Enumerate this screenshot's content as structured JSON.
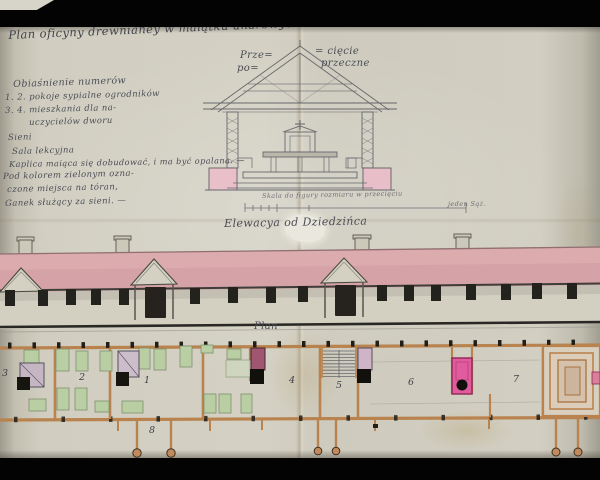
{
  "photo": {
    "description": "Photograph of a 19th-century hand-drawn architectural sheet (section, elevation, floor plan) on aged folded paper, letterboxed by black bars"
  },
  "title": "Plan oficyny drewnianey w maiątku unarowyckim Zameczku",
  "legend": {
    "heading": "Obiaśnienie numerów",
    "lines": [
      "1. 2. pokoje sypialne ogrodników",
      "3. 4. mieszkania dla na-",
      "uczycielów dworu",
      "Sieni",
      "Sala lekcyjna",
      "Kaplica maiąca się dobudować, i ma być opalana. —",
      "Pod kolorem zielonym ozna-",
      "czone miejsca na tóran,",
      "Ganek służący za sieni. —"
    ]
  },
  "cross_section": {
    "label_left_top": "Prze=",
    "label_left_bottom": "po=",
    "label_right_top": "= cięcie",
    "label_right_bottom": "przeczne"
  },
  "scale": {
    "caption": "Skala do figury rozmiaru w przecięciu",
    "unit_label": "jeden Sąż."
  },
  "elevation": {
    "caption": "Elewacya od Dziedzińca"
  },
  "plan": {
    "caption": "Plan",
    "rooms": [
      {
        "label": "3"
      },
      {
        "label": "2"
      },
      {
        "label": "1"
      },
      {
        "label": "4"
      },
      {
        "label": "5"
      },
      {
        "label": "6"
      },
      {
        "label": "7"
      },
      {
        "label": "8"
      }
    ]
  },
  "colors": {
    "roof_pink": "#d5a3a7",
    "foundation_pink": "#ecbcca",
    "stove_magenta": "#e15c9e",
    "furniture_green": "#b9cfa3",
    "timber_wall_tan": "#b9834f",
    "ink": "#4a4c55",
    "paper": "#d0cdc0"
  }
}
